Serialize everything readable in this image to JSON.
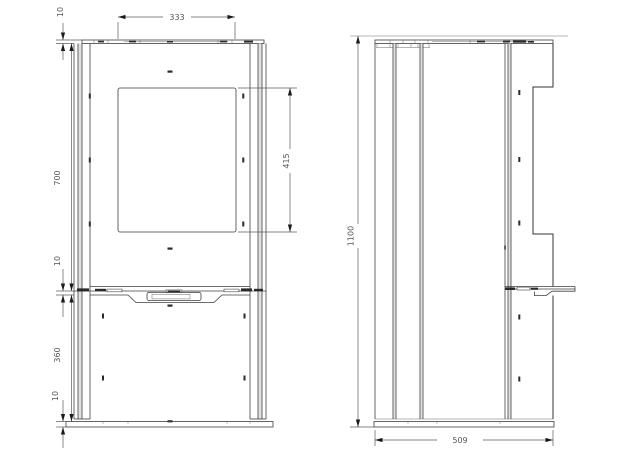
{
  "page": {
    "background_color": "#ffffff",
    "line_color": "#3f3f3f",
    "dimension_text_color": "#555555"
  },
  "dimensions": {
    "top_panel_thickness": "10",
    "top_opening_width": "333",
    "upper_section_height": "700",
    "door_panel_height": "415",
    "shelf_thickness": "10",
    "lower_section_height": "360",
    "base_thickness": "10",
    "overall_height": "1100",
    "overall_depth": "509"
  }
}
